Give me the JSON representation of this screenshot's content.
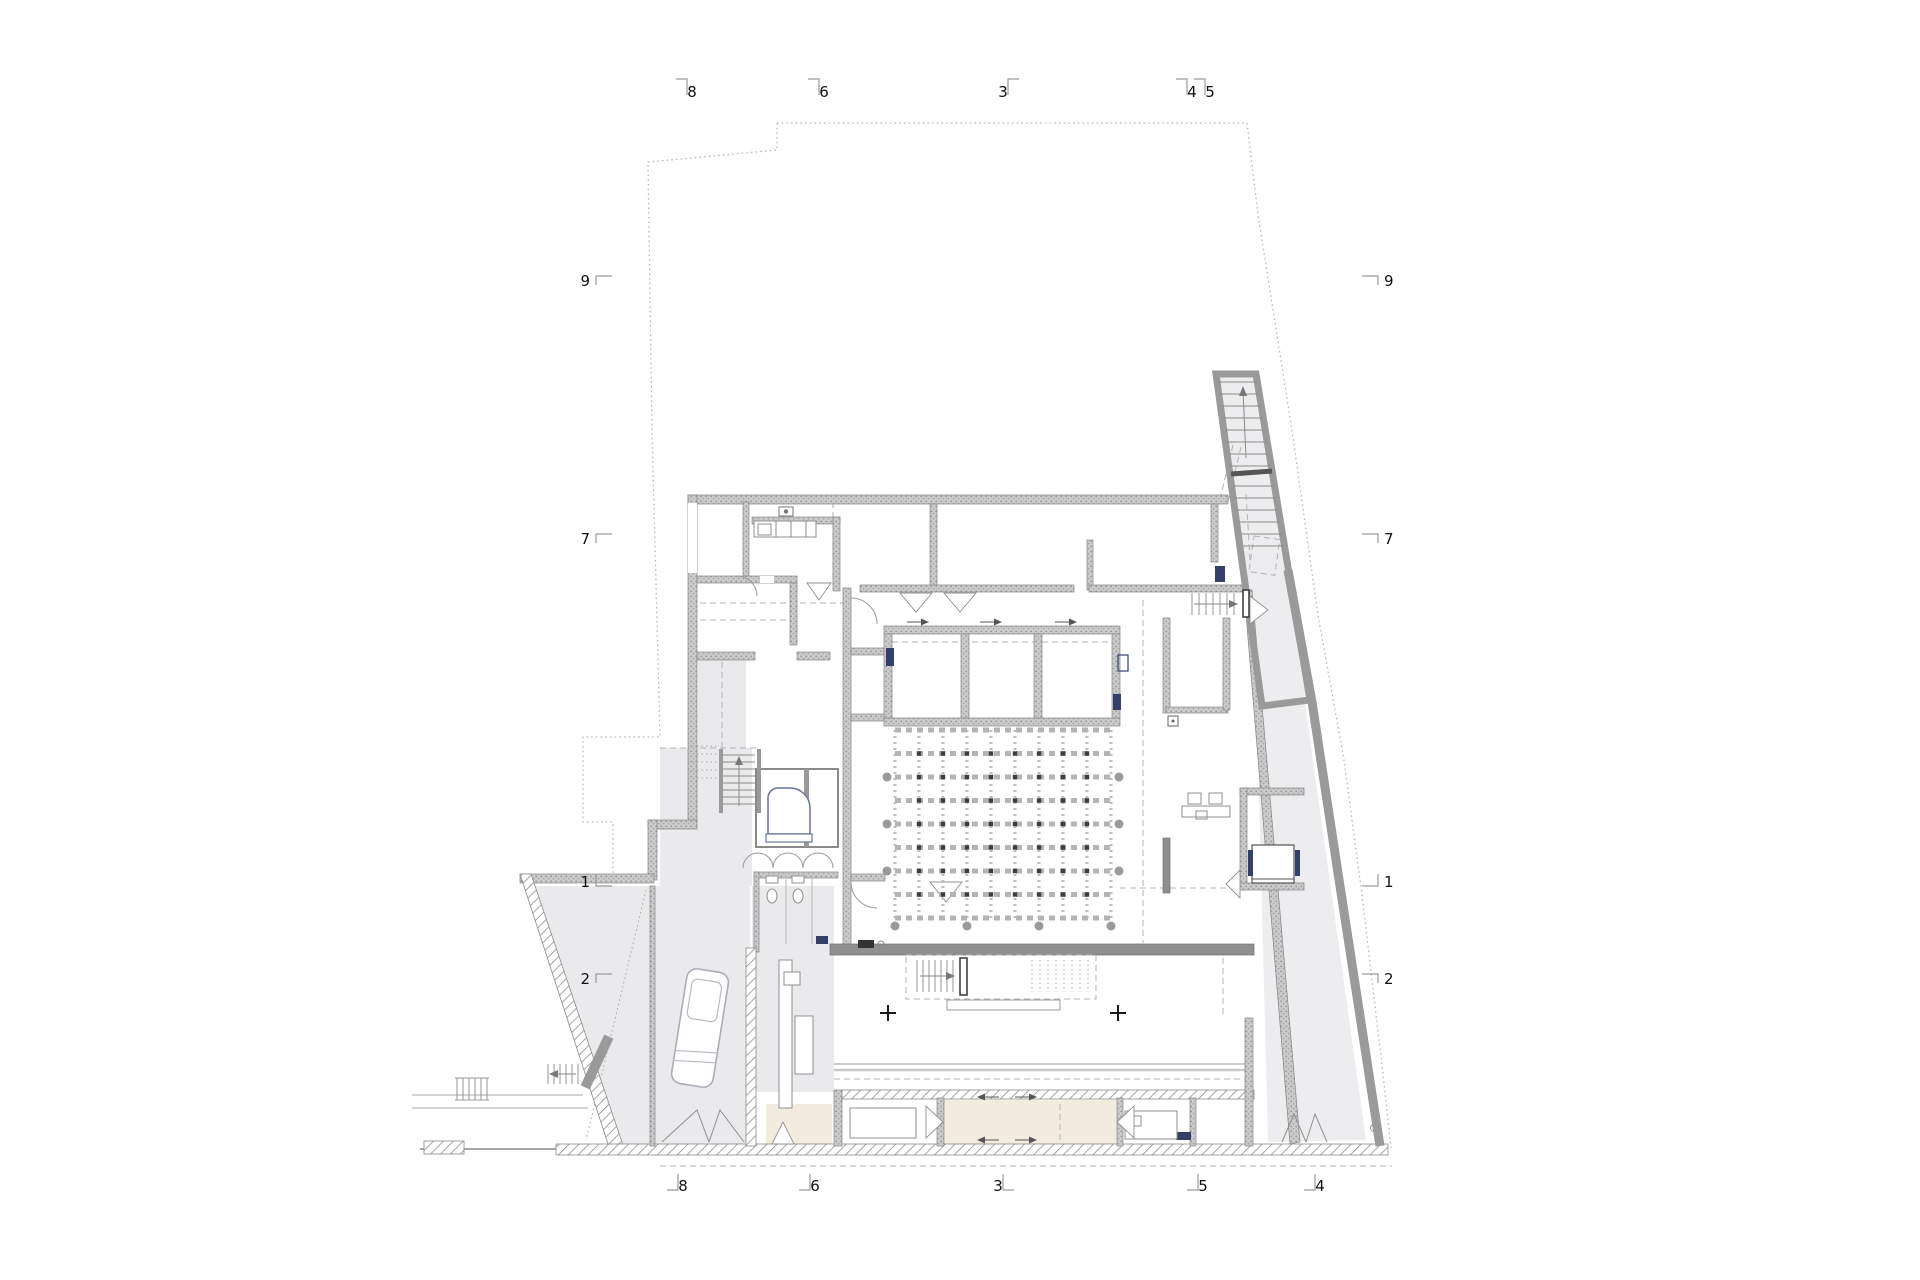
{
  "document": {
    "kind": "architectural-floor-plan",
    "level": "ground-floor",
    "background": "#ffffff"
  },
  "colors": {
    "wall": "#c6c6c6",
    "wall_solid": "#8f8f8f",
    "floor_gray": "#eaeaec",
    "ramp_gray": "#ededef",
    "room_beige": "#f2ecdf",
    "fixture_blue": "#33406a",
    "boundary": "#b5b5b5",
    "text": "#111111"
  },
  "section_markers": {
    "top": {
      "y": 92,
      "items": [
        {
          "label": "8",
          "x": 692,
          "tick": "tl"
        },
        {
          "label": "6",
          "x": 824,
          "tick": "tl"
        },
        {
          "label": "3",
          "x": 1003,
          "tick": "tr"
        },
        {
          "label": "4",
          "x": 1192,
          "tick": "tl"
        },
        {
          "label": "5",
          "x": 1210,
          "tick": "tl"
        }
      ]
    },
    "bottom": {
      "y": 1186,
      "items": [
        {
          "label": "8",
          "x": 683,
          "tick": "bl"
        },
        {
          "label": "6",
          "x": 815,
          "tick": "bl"
        },
        {
          "label": "3",
          "x": 998,
          "tick": "br"
        },
        {
          "label": "5",
          "x": 1203,
          "tick": "bl"
        },
        {
          "label": "4",
          "x": 1320,
          "tick": "bl"
        }
      ]
    },
    "left": {
      "x": 592,
      "items": [
        {
          "label": "9",
          "y": 281,
          "tick": "rt"
        },
        {
          "label": "7",
          "y": 539,
          "tick": "rt"
        },
        {
          "label": "1",
          "y": 882,
          "tick": "rb"
        },
        {
          "label": "2",
          "y": 979,
          "tick": "rt"
        }
      ]
    },
    "right": {
      "x": 1382,
      "items": [
        {
          "label": "9",
          "y": 281,
          "tick": "lt"
        },
        {
          "label": "7",
          "y": 539,
          "tick": "lt"
        },
        {
          "label": "1",
          "y": 882,
          "tick": "lb"
        },
        {
          "label": "2",
          "y": 979,
          "tick": "lt"
        }
      ]
    }
  },
  "hall_grid": {
    "x0": 895,
    "y0": 730,
    "cols": 10,
    "rows": 9,
    "dx": 24,
    "dy": 23.5,
    "edge_circle_rows": [
      2,
      4,
      6
    ],
    "bottom_circle_cols": [
      0,
      3,
      6,
      9
    ]
  },
  "annotations": {
    "plus_marks": [
      {
        "x": 888,
        "y": 1013
      },
      {
        "x": 1118,
        "y": 1013
      }
    ],
    "bay_arrows": [
      {
        "x": 918,
        "y": 622,
        "dir": "right"
      },
      {
        "x": 991,
        "y": 622,
        "dir": "right"
      },
      {
        "x": 1066,
        "y": 622,
        "dir": "right"
      }
    ],
    "corridor_arrows": [
      {
        "x": 988,
        "y": 1097,
        "dir": "left"
      },
      {
        "x": 1026,
        "y": 1097,
        "dir": "right"
      },
      {
        "x": 988,
        "y": 1140,
        "dir": "left"
      },
      {
        "x": 1026,
        "y": 1140,
        "dir": "right"
      }
    ]
  }
}
